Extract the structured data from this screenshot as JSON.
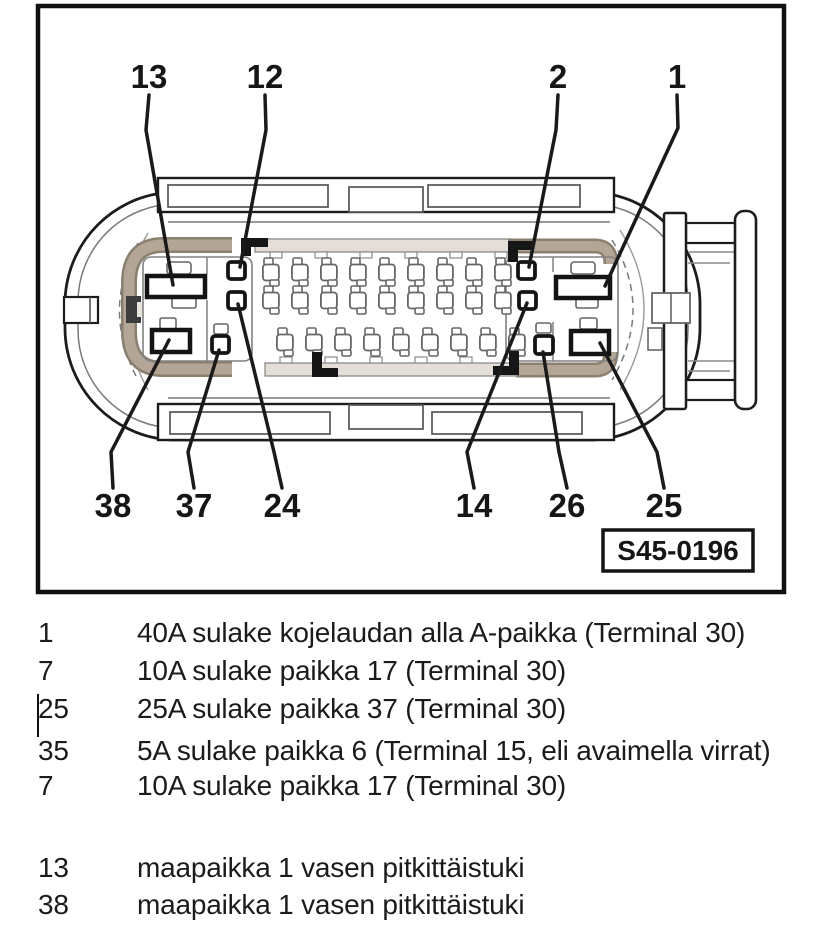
{
  "figure": {
    "code": "S45-0196",
    "callouts": [
      {
        "label": "13"
      },
      {
        "label": "12"
      },
      {
        "label": "2"
      },
      {
        "label": "1"
      },
      {
        "label": "38"
      },
      {
        "label": "37"
      },
      {
        "label": "24"
      },
      {
        "label": "14"
      },
      {
        "label": "26"
      },
      {
        "label": "25"
      }
    ]
  },
  "legend": {
    "rows": [
      {
        "pin": "1",
        "desc": "40A sulake kojelaudan alla A-paikka (Terminal 30)"
      },
      {
        "pin": "7",
        "desc": "10A sulake paikka 17 (Terminal 30)"
      },
      {
        "pin": "25",
        "desc": "25A sulake paikka 37 (Terminal 30)"
      },
      {
        "pin": "35",
        "desc": "5A sulake paikka 6 (Terminal 15, eli avaimella virrat)"
      },
      {
        "pin": "7",
        "desc": "10A sulake paikka 17 (Terminal 30)"
      },
      {
        "pin": "13",
        "desc": "maapaikka 1 vasen pitkittäistuki"
      },
      {
        "pin": "38",
        "desc": "maapaikka 1 vasen pitkittäistuki"
      }
    ]
  },
  "colors": {
    "seal_tan": "#b3a696",
    "seal_edge": "#8b7f70",
    "line_dark": "#1c1c1c",
    "line_gray": "#787878"
  }
}
